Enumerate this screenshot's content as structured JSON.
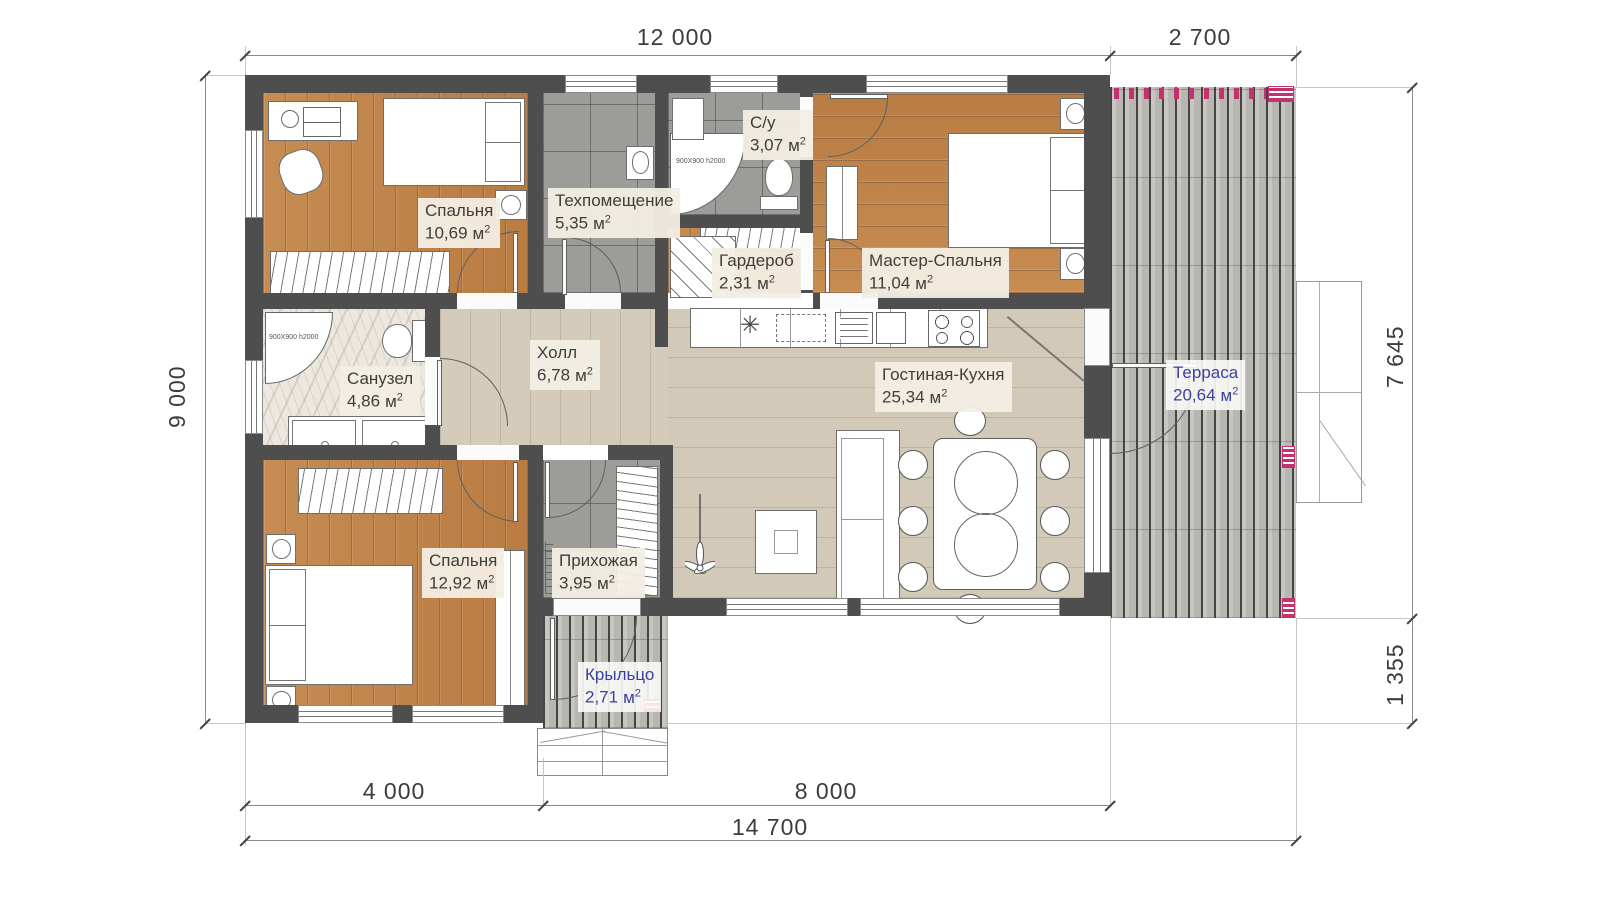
{
  "units": {
    "base": "м",
    "sup": "2"
  },
  "rooms": [
    {
      "key": "bedroom-1",
      "name": "Спальня",
      "area": "10,69"
    },
    {
      "key": "tech-room",
      "name": "Техпомещение",
      "area": "5,35"
    },
    {
      "key": "wc",
      "name": "С/у",
      "area": "3,07"
    },
    {
      "key": "wardrobe",
      "name": "Гардероб",
      "area": "2,31"
    },
    {
      "key": "master-bedroom",
      "name": "Мастер-Спальня",
      "area": "11,04"
    },
    {
      "key": "bathroom",
      "name": "Санузел",
      "area": "4,86"
    },
    {
      "key": "hall",
      "name": "Холл",
      "area": "6,78"
    },
    {
      "key": "living-kitchen",
      "name": "Гостиная-Кухня",
      "area": "25,34"
    },
    {
      "key": "bedroom-2",
      "name": "Спальня",
      "area": "12,92"
    },
    {
      "key": "entry-hall",
      "name": "Прихожая",
      "area": "3,95"
    },
    {
      "key": "terrace",
      "name": "Терраса",
      "area": "20,64"
    },
    {
      "key": "porch",
      "name": "Крыльцо",
      "area": "2,71"
    }
  ],
  "dimensions": {
    "top_house": "12 000",
    "top_terrace": "2 700",
    "left_side": "9 000",
    "right_upper": "7 645",
    "right_lower": "1 355",
    "bottom_left": "4 000",
    "bottom_right": "8 000",
    "bottom_total": "14 700"
  },
  "annotations": {
    "shower_wc": "900X900 h2000",
    "shower_bath": "900X900 h2000"
  },
  "icons": {
    "sink_burner": "✳"
  },
  "colors": {
    "wall": "#4e4e4e",
    "wood_floor": "#c2854b",
    "light_floor": "#d3c9b8",
    "tile_floor": "#9c9c98",
    "deck": "#c0beb9",
    "accent_pink": "#c5306f",
    "label_bg": "#f3eee4",
    "label_text": "#3e3e3c",
    "blue_label": "#3a41a3",
    "dimension_text": "#3c3c3c"
  }
}
